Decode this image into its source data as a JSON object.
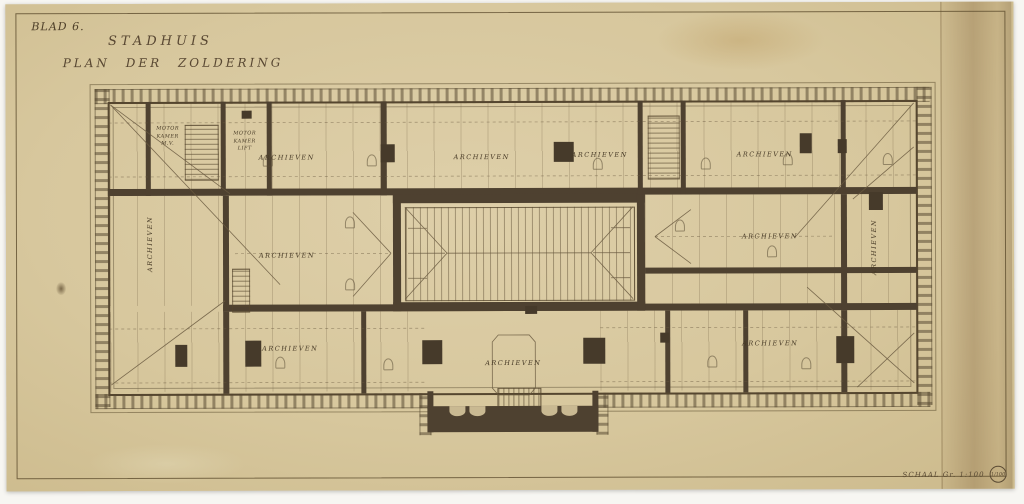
{
  "document": {
    "sheet_number": "BLAD 6.",
    "title_line1": "STADHUIS",
    "title_line2": "PLAN DER ZOLDERING",
    "scale_label": "SCHAAL Gr. 1:100",
    "scale_fraction": "1/100"
  },
  "rooms": {
    "archieven": "ARCHIEVEN",
    "motor_mv": [
      "MOTOR",
      "KAMER",
      "M.V."
    ],
    "motor_lift": [
      "MOTOR",
      "KAMER",
      "LIFT"
    ]
  },
  "colors": {
    "paper": "#d7c79d",
    "ink": "#5a4a33",
    "wall": "#4e4130"
  }
}
